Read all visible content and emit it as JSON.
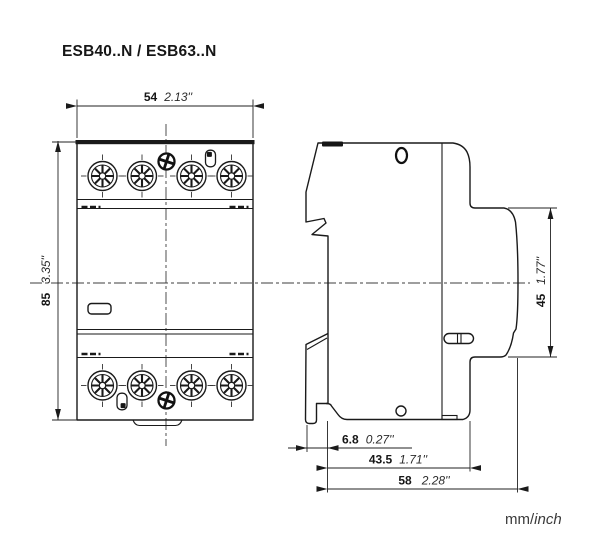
{
  "title": "ESB40..N / ESB63..N",
  "footer": {
    "units_mm": "mm/",
    "units_inch": "inch"
  },
  "dimensions": {
    "width": {
      "mm": "54",
      "inch": "2.13''"
    },
    "height": {
      "mm": "85",
      "inch": "3.35''"
    },
    "contact_block_height": {
      "mm": "45",
      "inch": "1.77''"
    },
    "clip_overhang_depth": {
      "mm": "6.8",
      "inch": "0.27''"
    },
    "body_depth": {
      "mm": "43.5",
      "inch": "1.71''"
    },
    "total_depth": {
      "mm": "58",
      "inch": "2.28''"
    }
  },
  "colors": {
    "ink": "#1a1a1a",
    "background": "#ffffff"
  }
}
